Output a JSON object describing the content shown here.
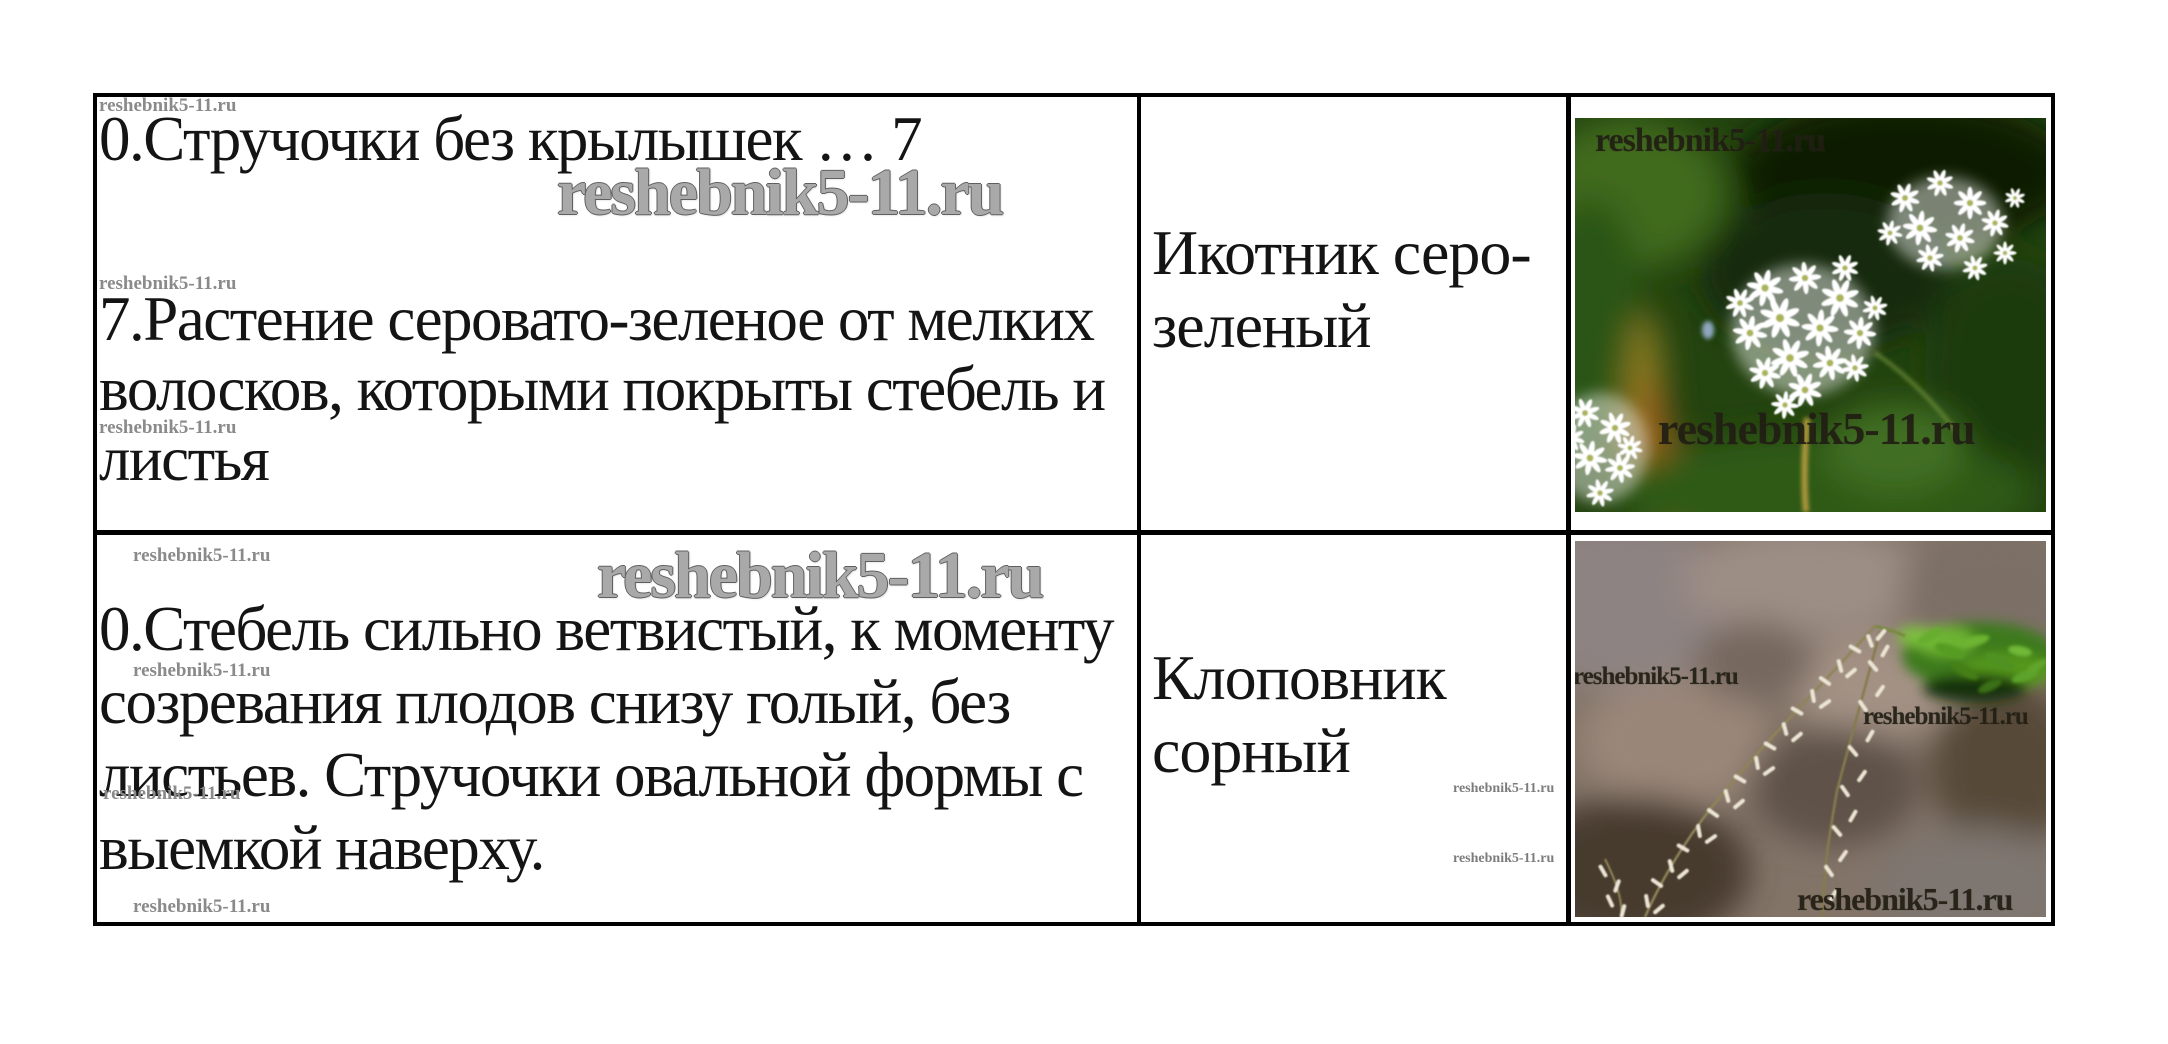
{
  "watermark": {
    "text": "reshebnik5-11.ru"
  },
  "table": {
    "rows": [
      {
        "key_lines": [
          "0.Стручочки без крылышек … 7",
          "7.Растение серовато-зеленое от мелких",
          "волосков, которыми покрыты стебель и",
          "листья"
        ],
        "plant_name_lines": [
          "Икотник серо-",
          "зеленый"
        ]
      },
      {
        "key_lines": [
          "0.Стебель сильно ветвистый, к моменту",
          "созревания плодов снизу голый, без",
          "листьев. Стручочки овальной формы с",
          "выемкой наверху."
        ],
        "plant_name_lines": [
          "Клоповник",
          "сорный"
        ]
      }
    ]
  }
}
